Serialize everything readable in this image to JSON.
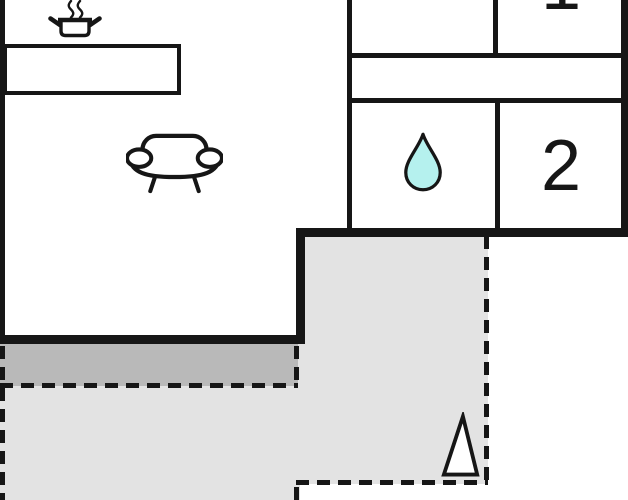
{
  "floorplan": {
    "type": "apartment-floor-plan",
    "colors": {
      "background": "#ffffff",
      "walls": "#161616",
      "terrace_light": "#e3e3e3",
      "terrace_dark": "#b9b9b9",
      "water_drop": "#b5f1ee"
    },
    "rooms": {
      "living_room": {
        "icons": [
          "cooking-pot-icon",
          "sofa-icon"
        ],
        "features": [
          "kitchen-counter"
        ]
      },
      "hallway": {
        "icons": []
      },
      "bathroom": {
        "icons": [
          "water-drop-icon"
        ]
      },
      "bedroom_1": {
        "label": "1"
      },
      "bedroom_2": {
        "label": "2"
      },
      "terrace": {
        "icons": [
          "tree-triangle-icon"
        ],
        "border_style": "dashed"
      }
    }
  }
}
